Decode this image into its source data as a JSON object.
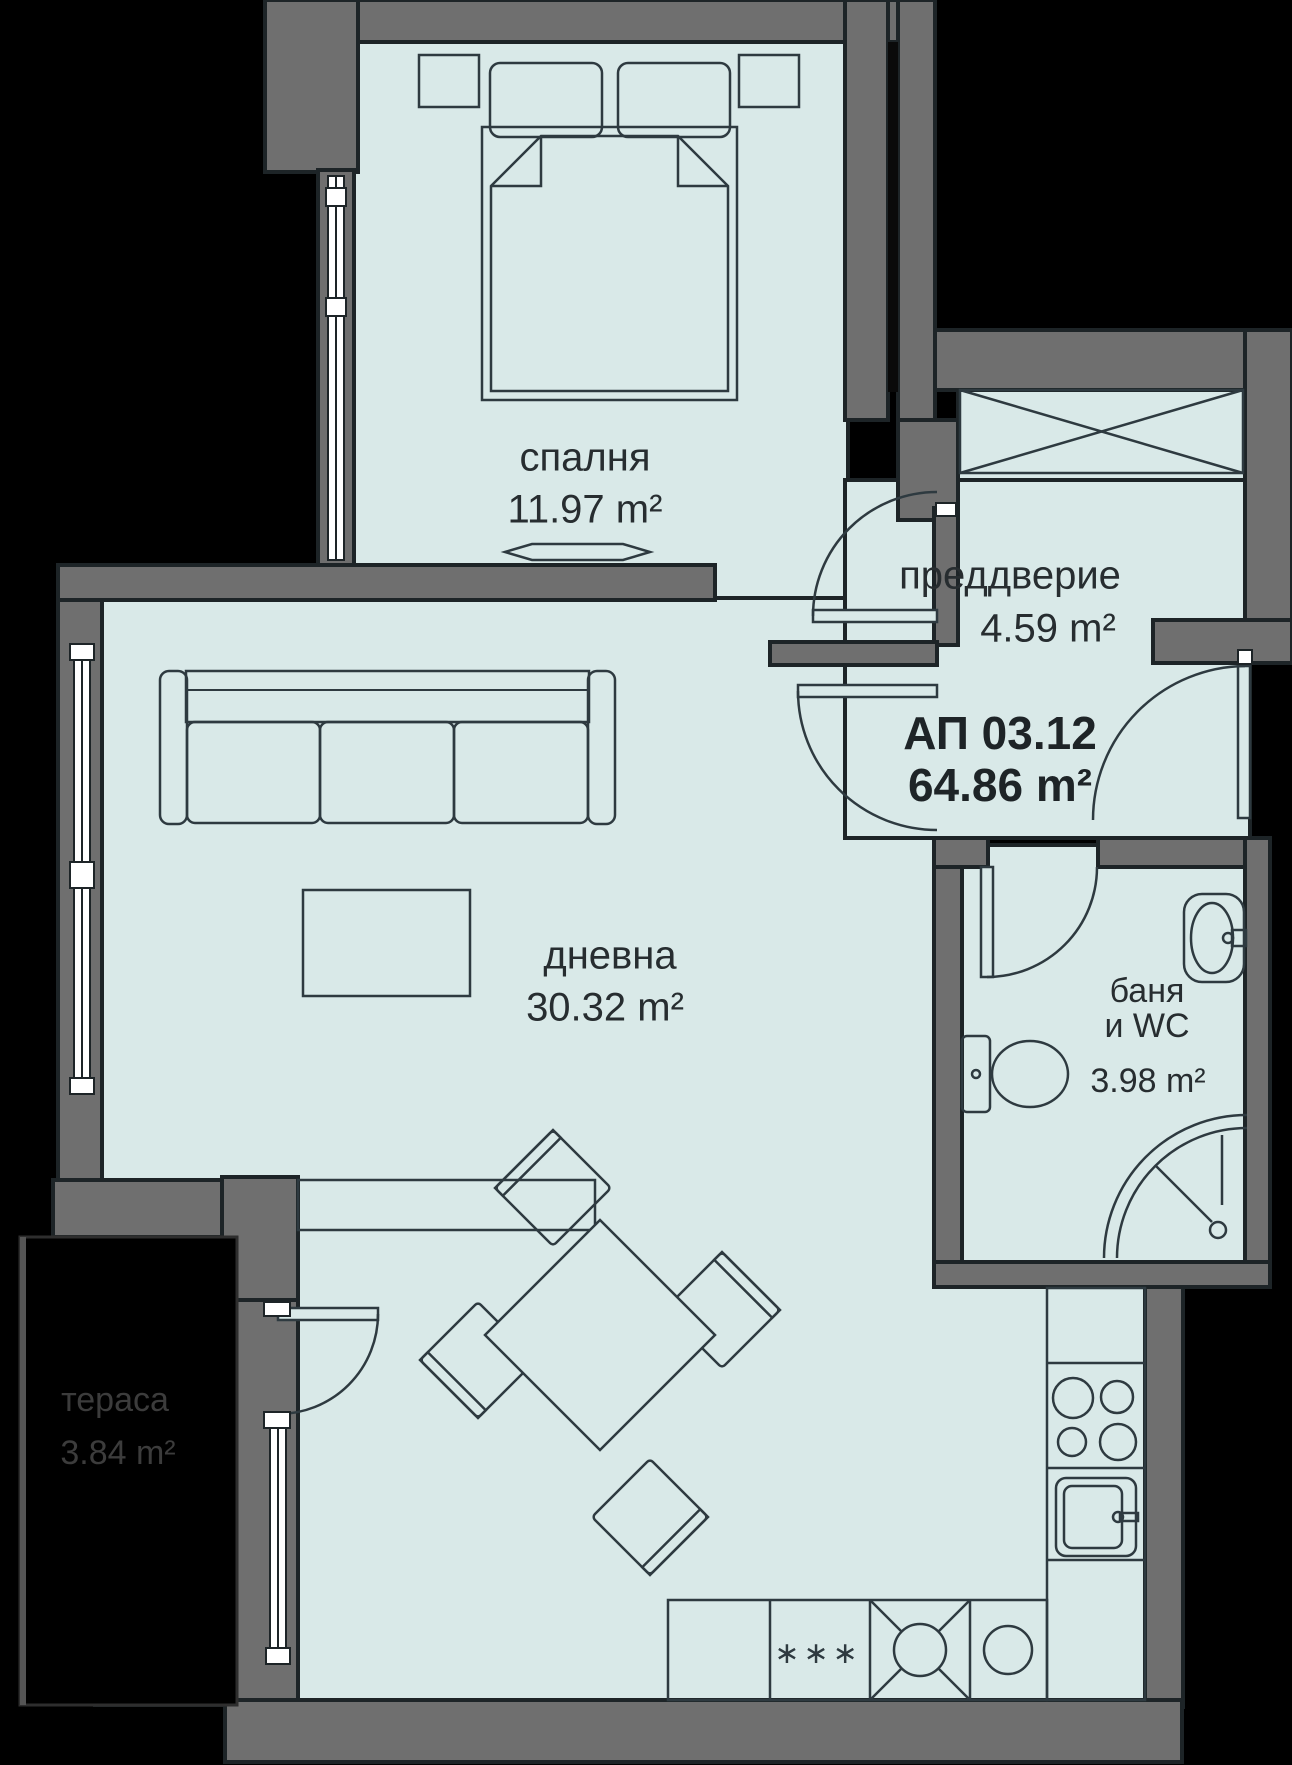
{
  "plan": {
    "apartment": {
      "id": "АП 03.12",
      "area": "64.86 m²"
    },
    "rooms": {
      "bedroom": {
        "label": "спалня",
        "area": "11.97 m²"
      },
      "hallway": {
        "label": "преддверие",
        "area": "4.59 m²"
      },
      "living": {
        "label": "дневна",
        "area": "30.32 m²"
      },
      "bathroom": {
        "label": "баня",
        "label2": "и WC",
        "area": "3.98 m²"
      },
      "terrace": {
        "label": "тераса",
        "area": "3.84 m²"
      }
    },
    "kitchen_marks": "∗∗∗",
    "colors": {
      "floor": "#d9e9e8",
      "wall": "#6f6f6f",
      "outline": "#1d2427",
      "furniture_line": "#2e3a40",
      "background": "#000000",
      "terrace_text": "#3c3c3c",
      "label_text": "#272d30"
    }
  }
}
